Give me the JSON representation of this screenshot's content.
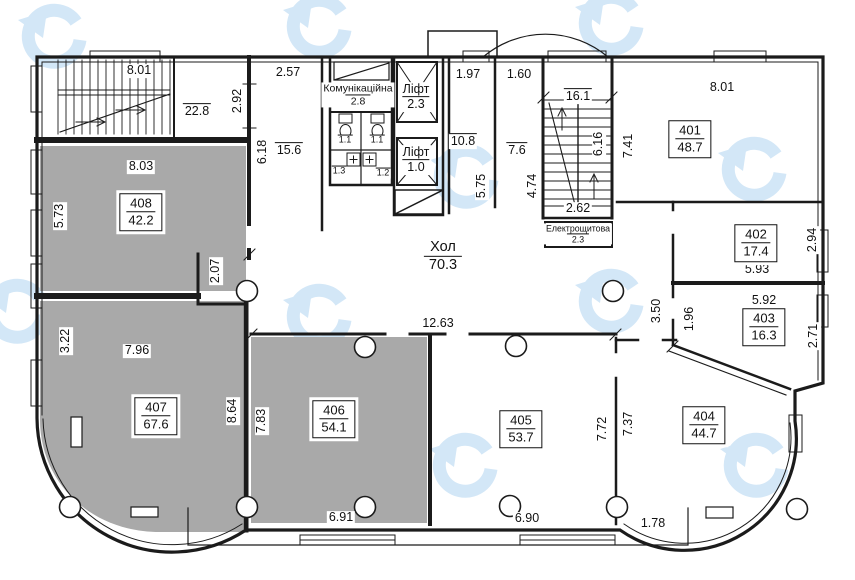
{
  "plan": {
    "hall": {
      "name": "Хол",
      "area": "70.3"
    },
    "lift_top": {
      "name": "Ліфт",
      "area": "2.3"
    },
    "lift_bottom": {
      "name": "Ліфт",
      "area": "1.0"
    },
    "comm_room": {
      "name": "Комунікаційна",
      "area": "2.8"
    },
    "electrical_room": {
      "name": "Електрощитова",
      "area": "2.3"
    },
    "wc_areas": [
      "1.1",
      "1.1",
      "1.3",
      "1.2"
    ],
    "service_areas": {
      "stair_left": "22.8",
      "corridor": "15.6",
      "stair_right": "16.1",
      "lobby_lift": "10.8",
      "lobby_stair": "7.6"
    }
  },
  "rooms": [
    {
      "num": "401",
      "area": "48.7"
    },
    {
      "num": "402",
      "area": "17.4"
    },
    {
      "num": "403",
      "area": "16.3"
    },
    {
      "num": "404",
      "area": "44.7"
    },
    {
      "num": "405",
      "area": "53.7"
    },
    {
      "num": "406",
      "area": "54.1"
    },
    {
      "num": "407",
      "area": "67.6"
    },
    {
      "num": "408",
      "area": "42.2"
    }
  ],
  "dims": {
    "stair1_w": "8.01",
    "stair1_d": "2.92",
    "corr_w": "2.57",
    "corr_len": "6.18",
    "r408_w": "8.03",
    "r408_d": "5.73",
    "lobby1_w": "1.97",
    "lobby2_w": "1.60",
    "lobby1_len": "5.75",
    "lobby2_len": "4.74",
    "stair2_len": "6.16",
    "stair2_w": "2.62",
    "r401_w": "8.01",
    "r401_d": "7.41",
    "r402_w": "5.93",
    "r402_d": "2.94",
    "r403_w": "5.92",
    "r403_d": "2.71",
    "hall_w": "12.63",
    "hall_d1": "3.50",
    "hall_d2": "1.96",
    "corr207": "2.07",
    "r407_w": "7.96",
    "r407_d1": "3.22",
    "r407_d2": "8.64",
    "r406_w": "6.91",
    "r406_d": "7.83",
    "r405_w": "6.90",
    "r405_d": "7.72",
    "r404_w": "1.78",
    "r404_d": "7.37"
  },
  "colors": {
    "wall": "#1b1b1b",
    "gray_room": "#a9a9a9",
    "watermark": "#d3e7f7"
  }
}
